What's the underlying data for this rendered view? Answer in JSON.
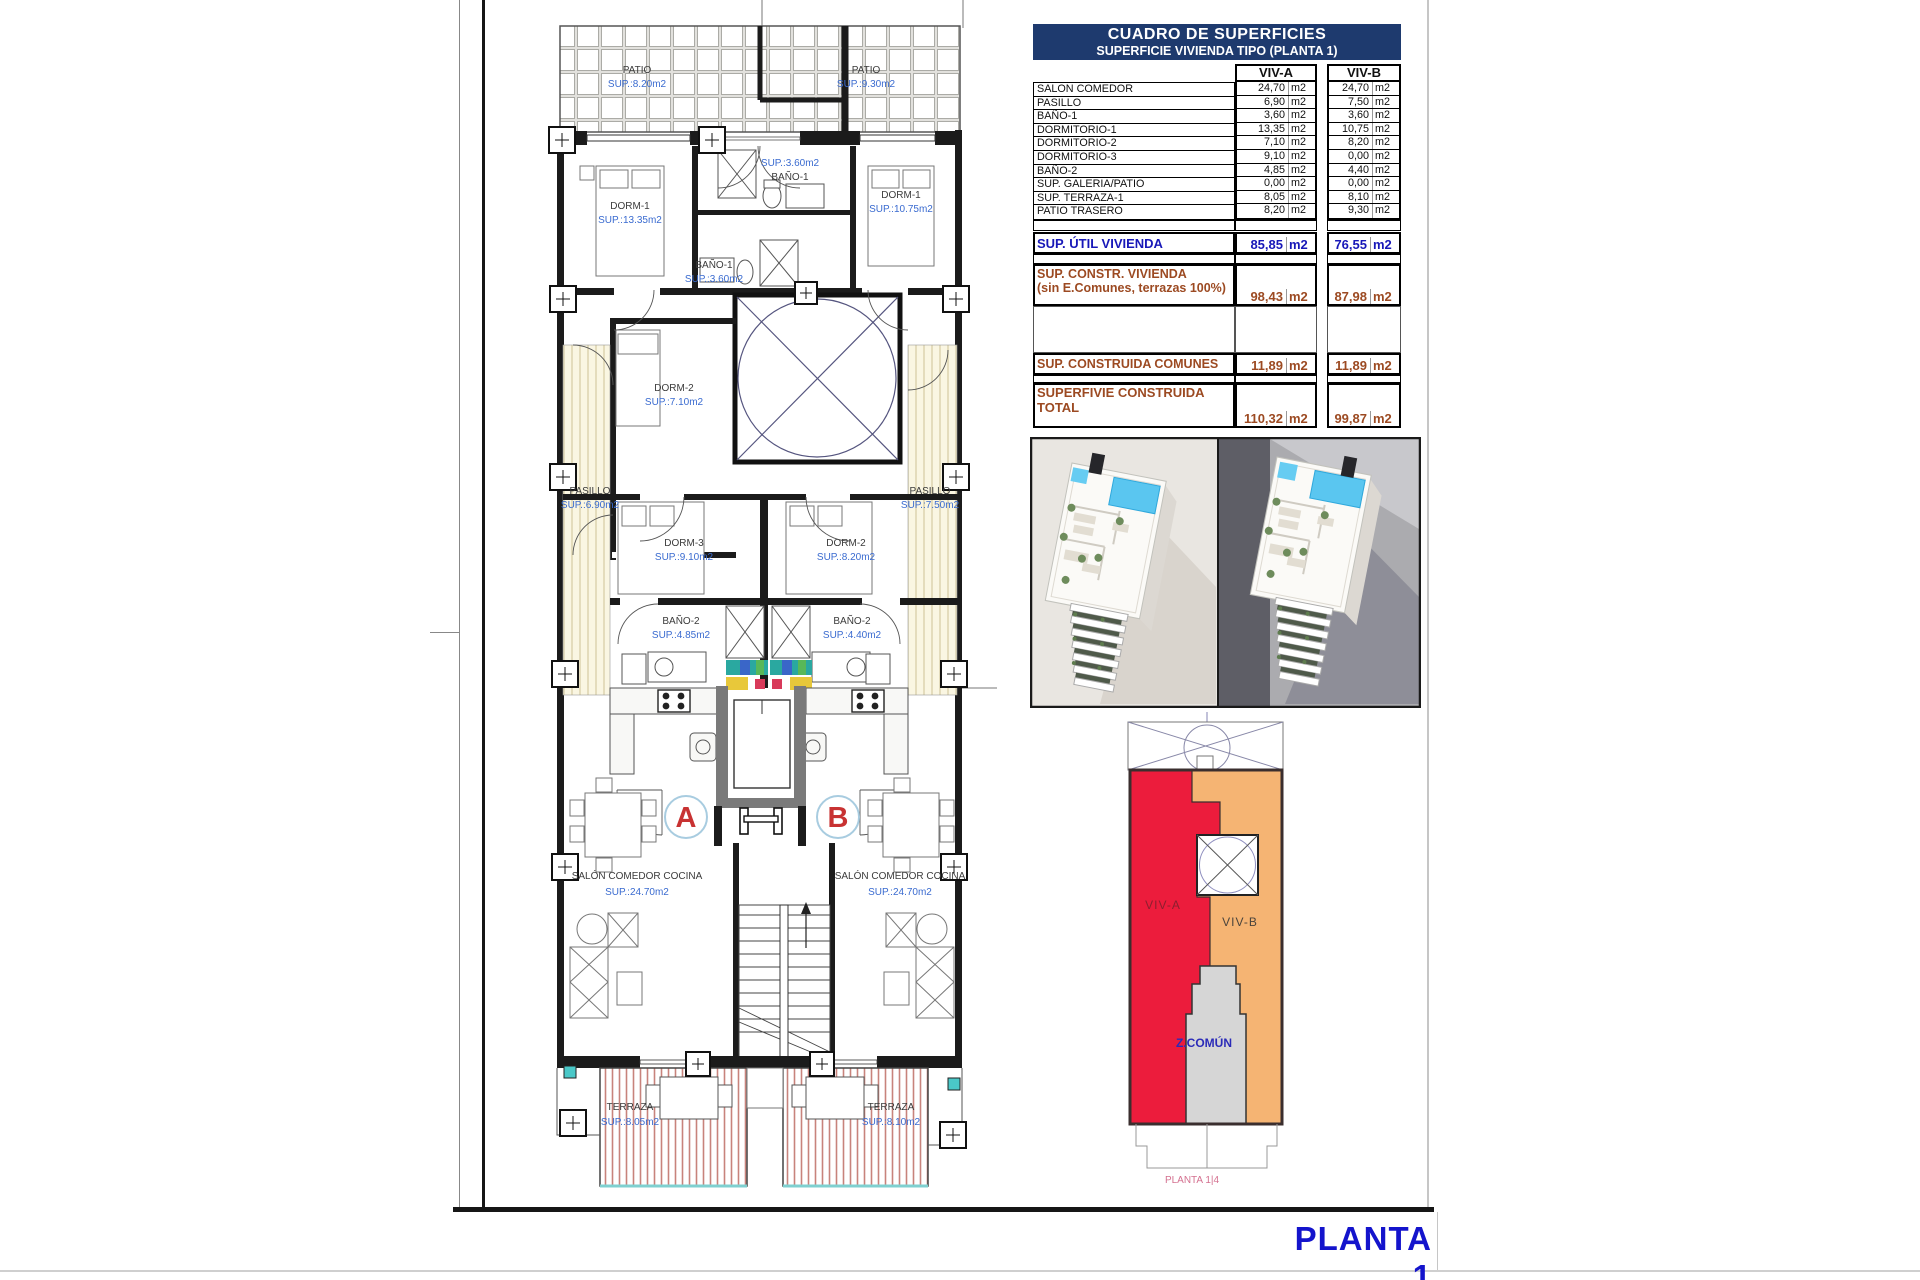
{
  "sheet": {
    "title": "PLANTA 1"
  },
  "table": {
    "title1": "CUADRO DE SUPERFICIES",
    "title2": "SUPERFICIE VIVIENDA TIPO  (PLANTA 1)",
    "col_a": "VIV-A",
    "col_b": "VIV-B",
    "unit": "m2",
    "rows": [
      {
        "label": "SALON COMEDOR",
        "a": "24,70",
        "b": "24,70"
      },
      {
        "label": "PASILLO",
        "a": "6,90",
        "b": "7,50"
      },
      {
        "label": "BAÑO-1",
        "a": "3,60",
        "b": "3,60"
      },
      {
        "label": "DORMITORIO-1",
        "a": "13,35",
        "b": "10,75"
      },
      {
        "label": "DORMITORIO-2",
        "a": "7,10",
        "b": "8,20"
      },
      {
        "label": "DORMITORIO-3",
        "a": "9,10",
        "b": "0,00"
      },
      {
        "label": "BAÑO-2",
        "a": "4,85",
        "b": "4,40"
      },
      {
        "label": "SUP. GALERIA/PATIO",
        "a": "0,00",
        "b": "0,00"
      },
      {
        "label": "SUP. TERRAZA-1",
        "a": "8,05",
        "b": "8,10"
      },
      {
        "label": "PATIO TRASERO",
        "a": "8,20",
        "b": "9,30"
      }
    ],
    "util": {
      "label": "SUP. ÚTIL VIVIENDA",
      "a": "85,85",
      "b": "76,55"
    },
    "constr": {
      "label": "SUP. CONSTR. VIVIENDA",
      "label2": "(sin E.Comunes, terrazas 100%)",
      "a": "98,43",
      "b": "87,98"
    },
    "comunes": {
      "label": "SUP. CONSTRUIDA COMUNES",
      "a": "11,89",
      "b": "11,89"
    },
    "total": {
      "label": "SUPERFIVIE CONSTRUIDA",
      "label2": "TOTAL",
      "a": "110,32",
      "b": "99,87"
    }
  },
  "plan": {
    "unit_a": "A",
    "unit_b": "B",
    "rooms": {
      "patio_a": {
        "name": "PATIO",
        "sup": "SUP.:8.20m2"
      },
      "patio_b": {
        "name": "PATIO",
        "sup": "SUP.:9.30m2"
      },
      "dorm1_a": {
        "name": "DORM-1",
        "sup": "SUP.:13.35m2"
      },
      "dorm1_b": {
        "name": "DORM-1",
        "sup": "SUP.:10.75m2"
      },
      "bano1_b": {
        "name": "BAÑO-1",
        "sup": "SUP.:3.60m2"
      },
      "bano1_a": {
        "name": "BAÑO-1",
        "sup": "SUP.:3.60m2"
      },
      "dorm2_a": {
        "name": "DORM-2",
        "sup": "SUP.:7.10m2"
      },
      "pasillo_a": {
        "name": "PASILLO",
        "sup": "SUP.:6.90m2"
      },
      "pasillo_b": {
        "name": "PASILLO",
        "sup": "SUP.:7.50m2"
      },
      "dorm3_a": {
        "name": "DORM-3",
        "sup": "SUP.:9.10m2"
      },
      "dorm2_b": {
        "name": "DORM-2",
        "sup": "SUP.:8.20m2"
      },
      "bano2_a": {
        "name": "BAÑO-2",
        "sup": "SUP.:4.85m2"
      },
      "bano2_b": {
        "name": "BAÑO-2",
        "sup": "SUP.:4.40m2"
      },
      "salon_a": {
        "name": "SALÓN COMEDOR COCINA",
        "sup": "SUP.:24.70m2"
      },
      "salon_b": {
        "name": "SALÓN COMEDOR COCINA",
        "sup": "SUP.:24.70m2"
      },
      "terraza_a": {
        "name": "TERRAZA",
        "sup": "SUP.:8.05m2"
      },
      "terraza_b": {
        "name": "TERRAZA",
        "sup": "SUP.:8.10m2"
      }
    }
  },
  "diagram": {
    "viv_a": "VIV-A",
    "viv_b": "VIV-B",
    "comun": "Z.COMÚN",
    "caption": "PLANTA 1|4"
  },
  "colors": {
    "header_navy": "#1E3A6E",
    "accent_blue": "#1818B8",
    "accent_brown": "#9C4A22",
    "title_blue": "#1414CC",
    "viv_a_red": "#EC1C3C",
    "viv_b_orange": "#F5B473",
    "comun_gray": "#D6D6D6",
    "plan_sup_blue": "#3A6BD0"
  }
}
